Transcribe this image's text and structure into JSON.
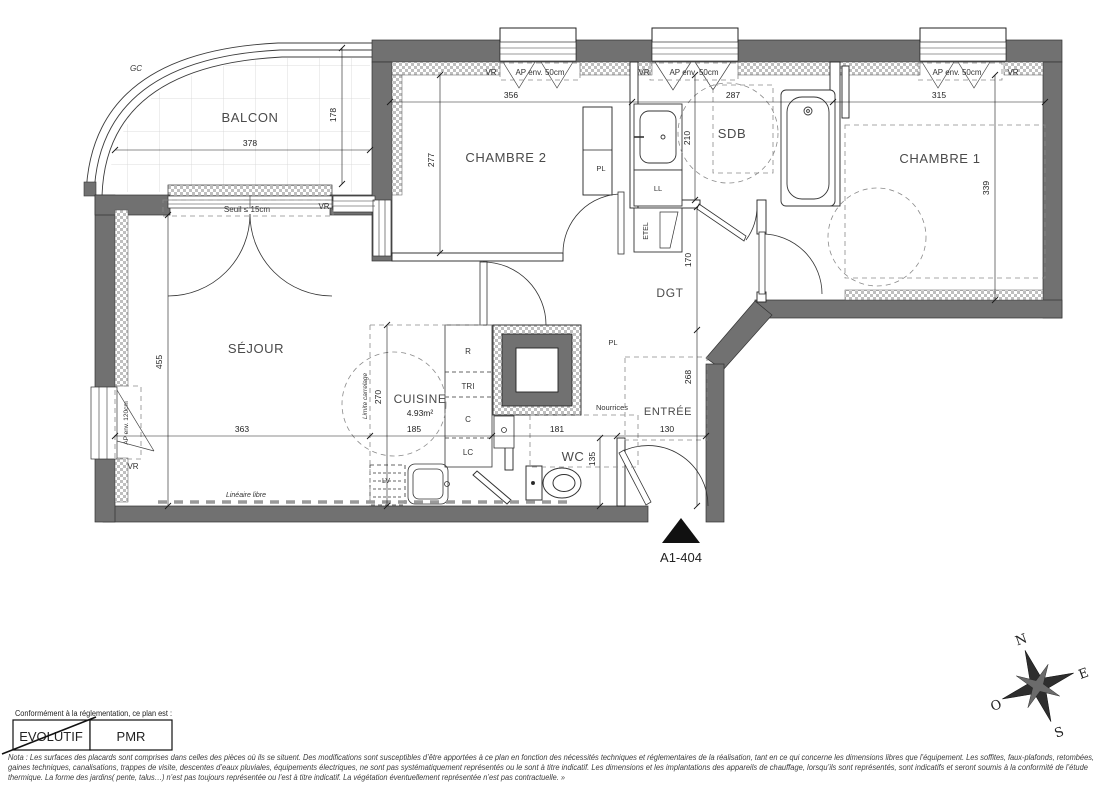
{
  "title": "A1-404",
  "rooms": {
    "balcon": "BALCON",
    "chambre2": "CHAMBRE 2",
    "sdb": "SDB",
    "chambre1": "CHAMBRE 1",
    "sejour": "SÉJOUR",
    "cuisine": "CUISINE",
    "cuisine_area": "4.93m²",
    "dgt": "DGT",
    "entree": "ENTRÉE",
    "wc": "WC"
  },
  "dimensions_cm": {
    "balcon_w": "378",
    "balcon_d": "178",
    "chambre2_w": "356",
    "chambre2_d": "277",
    "sdb_w": "287",
    "sdb_d": "210",
    "chambre1_w": "315",
    "chambre1_d": "339",
    "sejour_d": "455",
    "sejour_w": "363",
    "cuisine_w": "185",
    "cuisine_d": "270",
    "wc_w": "181",
    "wc_d": "135",
    "entree_w": "130",
    "entree_d": "268",
    "dgt_d": "170"
  },
  "annotations": {
    "gc": "GC",
    "vr": "VR",
    "ap_50": "AP env. 50cm",
    "ap_120": "AP env. 120cm",
    "seuil": "Seuil ≤ 15cm",
    "pl": "PL",
    "ll": "LL",
    "etel": "ETEL",
    "r": "R",
    "tri": "TRI",
    "c": "C",
    "lc": "LC",
    "lv": "LV",
    "nourrices": "Nourrices",
    "limite_carrelage": "Limite carrelage",
    "lineaire_libre": "Linéaire libre"
  },
  "compass": {
    "north": "N",
    "east": "E",
    "south": "S",
    "west": "O"
  },
  "legend": {
    "caption": "Conformément à la réglementation, ce plan est :",
    "evolutif": "EVOLUTIF",
    "pmr": "PMR"
  },
  "nota": {
    "line1": "Nota : Les surfaces des placards sont comprises dans celles des pièces où ils se situent. Des modifications sont susceptibles d’être apportées à ce plan en fonction des nécessités techniques et réglementaires de la réalisation, tant en ce qui concerne les dimensions libres que l’équipement.  Les soffites, faux-plafonds, retombées,",
    "line2": "gaines techniques, canalisations, trappes de visite, descentes d’eaux pluviales, équipements électriques, ne sont pas systématiquement représentés ou le sont à titre indicatif. Les dimensions et les implantations des appareils de chauffage, lorsqu’ils sont représentés, sont indicatifs et seront soumis à la conformité de l’étude",
    "line3": "thermique. La forme des jardins( pente, talus…) n’est pas toujours représentée ou l’est à titre indicatif. La végétation éventuellement représentée n’est pas contractuelle. »"
  },
  "colors": {
    "wall": "#717171"
  }
}
